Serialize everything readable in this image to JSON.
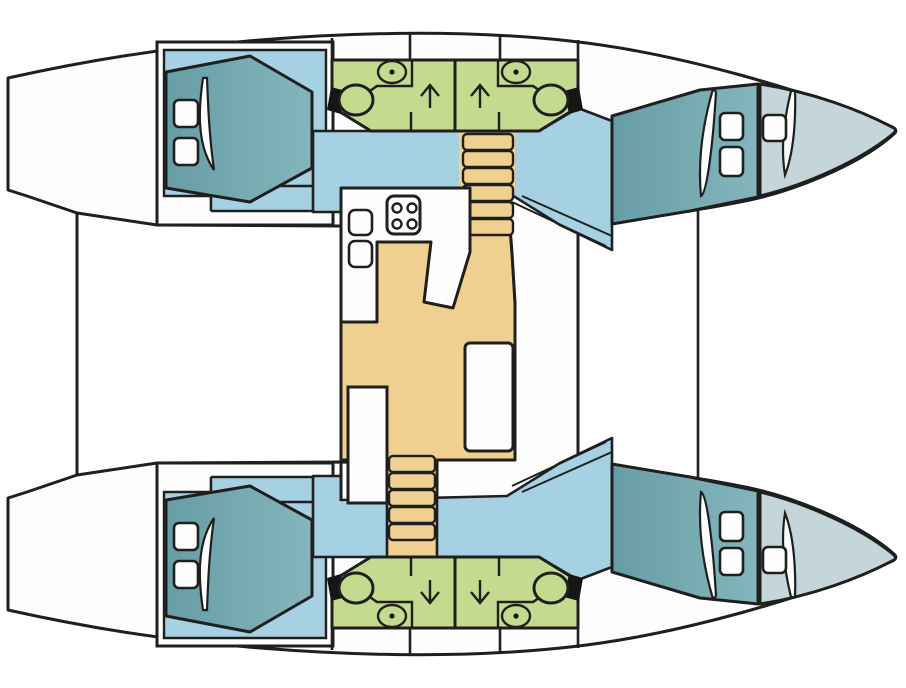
{
  "diagram": {
    "title": "catamaran-interior-floor-plan",
    "orientation": "bow-right",
    "hulls": [
      {
        "id": "port-hull",
        "position": "top"
      },
      {
        "id": "starboard-hull",
        "position": "bottom"
      }
    ],
    "rooms": [
      {
        "id": "port-aft-cabin",
        "kind": "cabin",
        "berth": "double",
        "hatches": 2
      },
      {
        "id": "port-forward-cabin",
        "kind": "cabin",
        "berth": "double",
        "hatches": 2
      },
      {
        "id": "port-bow-peak",
        "kind": "storage",
        "hatches": 1
      },
      {
        "id": "port-aft-head",
        "kind": "bathroom",
        "fixtures": [
          "toilet",
          "sink"
        ]
      },
      {
        "id": "port-forward-head",
        "kind": "bathroom",
        "fixtures": [
          "toilet",
          "sink"
        ]
      },
      {
        "id": "starboard-aft-cabin",
        "kind": "cabin",
        "berth": "double",
        "hatches": 2
      },
      {
        "id": "starboard-forward-cabin",
        "kind": "cabin",
        "berth": "double",
        "hatches": 2
      },
      {
        "id": "starboard-bow-peak",
        "kind": "storage",
        "hatches": 1
      },
      {
        "id": "starboard-aft-head",
        "kind": "bathroom",
        "fixtures": [
          "toilet",
          "sink"
        ]
      },
      {
        "id": "starboard-forward-head",
        "kind": "bathroom",
        "fixtures": [
          "toilet",
          "sink"
        ]
      },
      {
        "id": "galley",
        "kind": "galley",
        "fixtures": [
          "stove-4-burner",
          "sink",
          "sink"
        ]
      },
      {
        "id": "saloon",
        "kind": "saloon",
        "fixtures": [
          "table",
          "bench",
          "cabinet"
        ]
      }
    ],
    "stairs": [
      {
        "id": "port-companionway",
        "location": "top-center",
        "steps": 6
      },
      {
        "id": "starboard-companionway",
        "location": "bottom-center",
        "steps": 5
      }
    ],
    "arrows": [
      {
        "area": "port-heads",
        "direction": "up",
        "count": 2
      },
      {
        "area": "starboard-heads",
        "direction": "down",
        "count": 2
      }
    ],
    "counts": {
      "cabins": 4,
      "heads": 4,
      "double_berths": 4,
      "deck_hatches": 10,
      "stove_burners": 4
    }
  },
  "palette": {
    "outline": "#1f1f1f",
    "deck": "#FDFDFD",
    "sand": "#F0D091",
    "blue": "#A6D1E2",
    "teal": "#84B5BC",
    "teal_dark": "#679DA5",
    "pale": "#C4D6D9",
    "green": "#C4DB8F",
    "black": "#151515"
  }
}
